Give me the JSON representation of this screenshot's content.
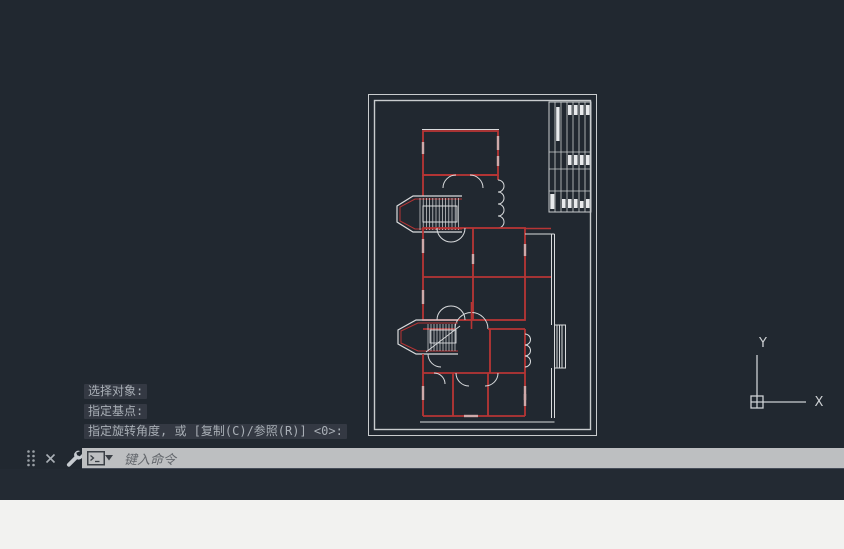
{
  "palette": {
    "canvas_bg": "#212830",
    "wall_red": "#b73535",
    "line_white": "#d9dbdd",
    "window_pink": "#cfa9a9",
    "frame_white": "#c9ccce",
    "input_strip_bg": "#bdbfc1",
    "history_chip_bg": "#343943",
    "history_text": "#a8aeb5",
    "bottom_area_bg": "#f2f2f0"
  },
  "command_history": {
    "lines": [
      "选择对象:",
      "指定基点:",
      "指定旋转角度, 或 [复制(C)/参照(R)] <0>:"
    ]
  },
  "command_bar": {
    "placeholder": "键入命令",
    "icons": [
      "grip-handle",
      "close",
      "customize-wrench",
      "command-prompt",
      "recent-commands-dropdown"
    ]
  },
  "ucs": {
    "y_label": "Y",
    "x_label": "X"
  }
}
